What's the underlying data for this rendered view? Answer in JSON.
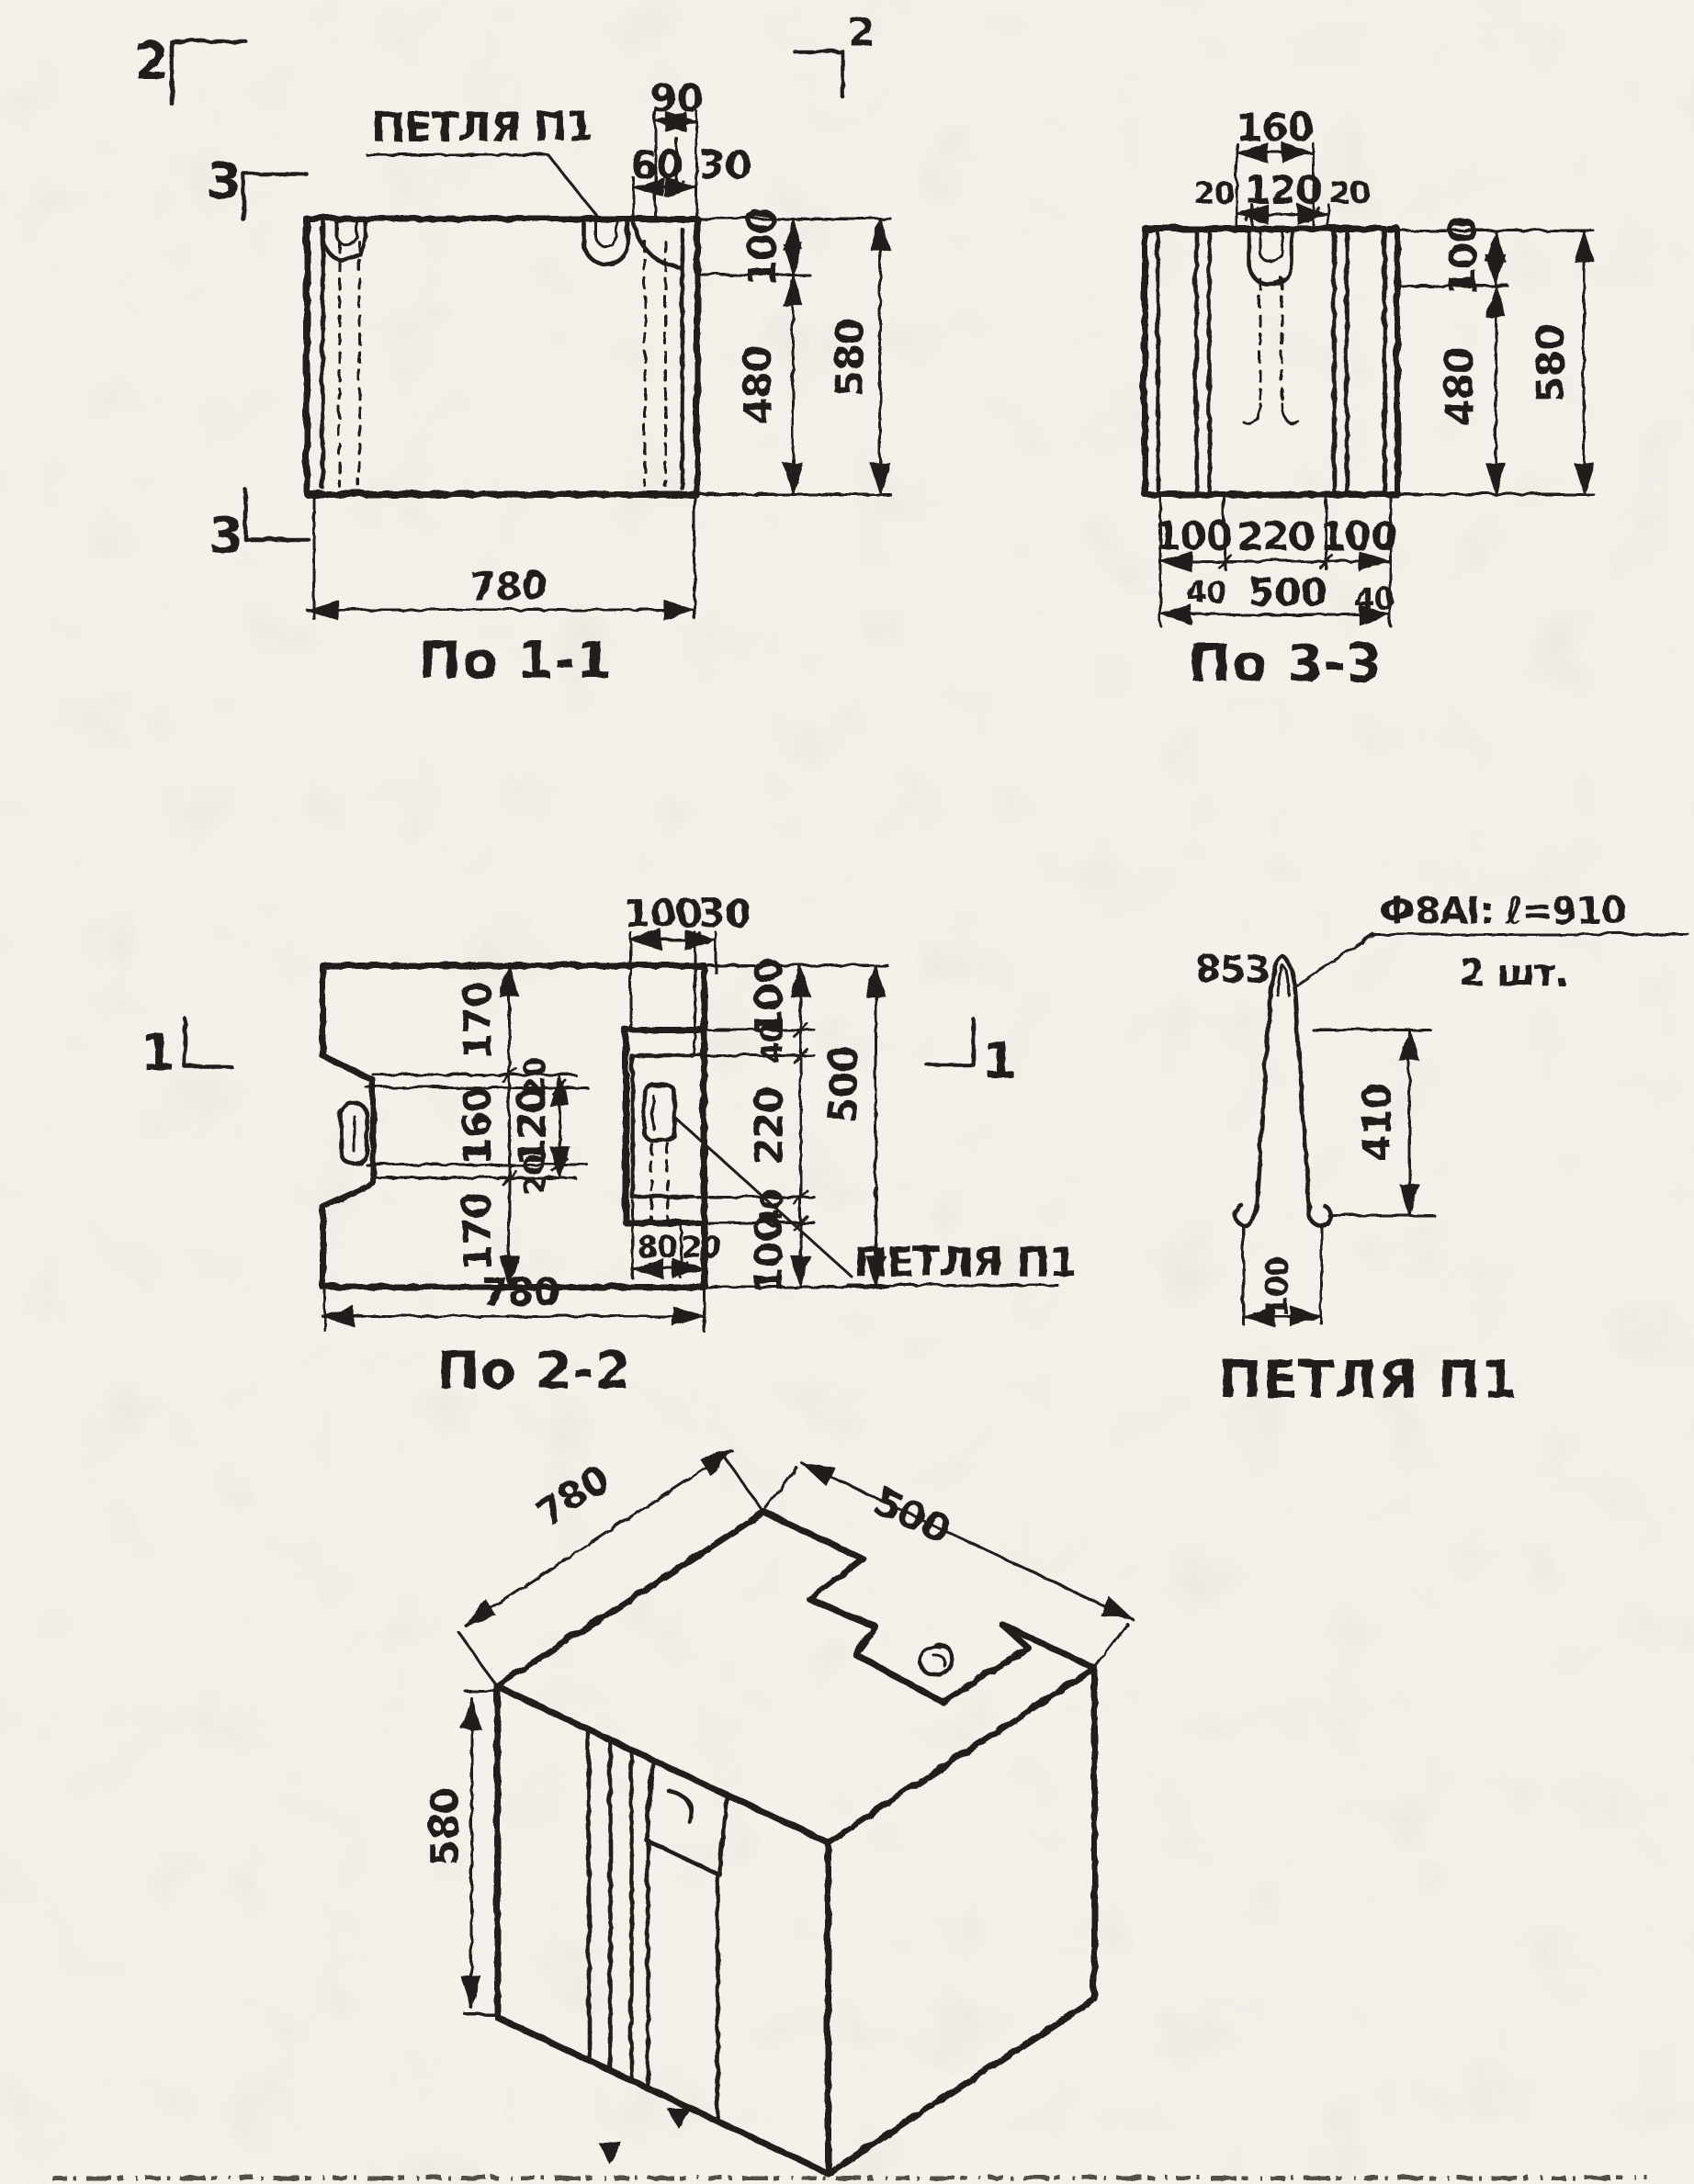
{
  "colors": {
    "ink": "#221f1a",
    "paper": "#f3f1ea"
  },
  "views": {
    "v11": {
      "title": "По 1-1",
      "callout": "ПЕТЛЯ П1",
      "dim_width": "780",
      "dim_top_total": "90",
      "dim_top_a": "60",
      "dim_top_b": "30",
      "dim_right_top": "100",
      "dim_right_mid": "480",
      "dim_right_total": "580"
    },
    "v33": {
      "title": "По 3-3",
      "dim_top_total": "160",
      "dim_top_a": "20",
      "dim_top_b": "120",
      "dim_top_c": "20",
      "dim_right_top": "100",
      "dim_right_mid": "480",
      "dim_right_total": "580",
      "dim_bot_a": "100",
      "dim_bot_b": "220",
      "dim_bot_c": "100",
      "dim_bot_40l": "40",
      "dim_bot_40r": "40",
      "dim_bot_total": "500"
    },
    "v22": {
      "title": "По 2-2",
      "callout": "ПЕТЛЯ П1",
      "dim_width": "780",
      "dim_top_a": "100",
      "dim_top_b": "30",
      "dim_left_a": "170",
      "dim_left_b": "160",
      "dim_left_c": "170",
      "dim_notch_a": "20",
      "dim_notch_b": "120",
      "dim_notch_c": "20",
      "dim_right_a": "100",
      "dim_right_b": "40",
      "dim_right_c": "220",
      "dim_right_d": "40",
      "dim_right_e": "100",
      "dim_right_total": "500",
      "dim_bot_a": "80",
      "dim_bot_b": "20"
    },
    "loop": {
      "title": "ПЕТЛЯ П1",
      "bend_note": "853",
      "spec_line1": "Ф8АI: ℓ=910",
      "spec_line2": "2 шт.",
      "dim_height": "410",
      "dim_width": "100"
    },
    "iso": {
      "dim_length": "780",
      "dim_depth": "500",
      "dim_height": "580"
    }
  },
  "section_marks": {
    "m2_left": "2",
    "m2_right": "2",
    "m3_top": "3",
    "m3_bottom": "3",
    "m1_left": "1",
    "m1_right": "1"
  }
}
